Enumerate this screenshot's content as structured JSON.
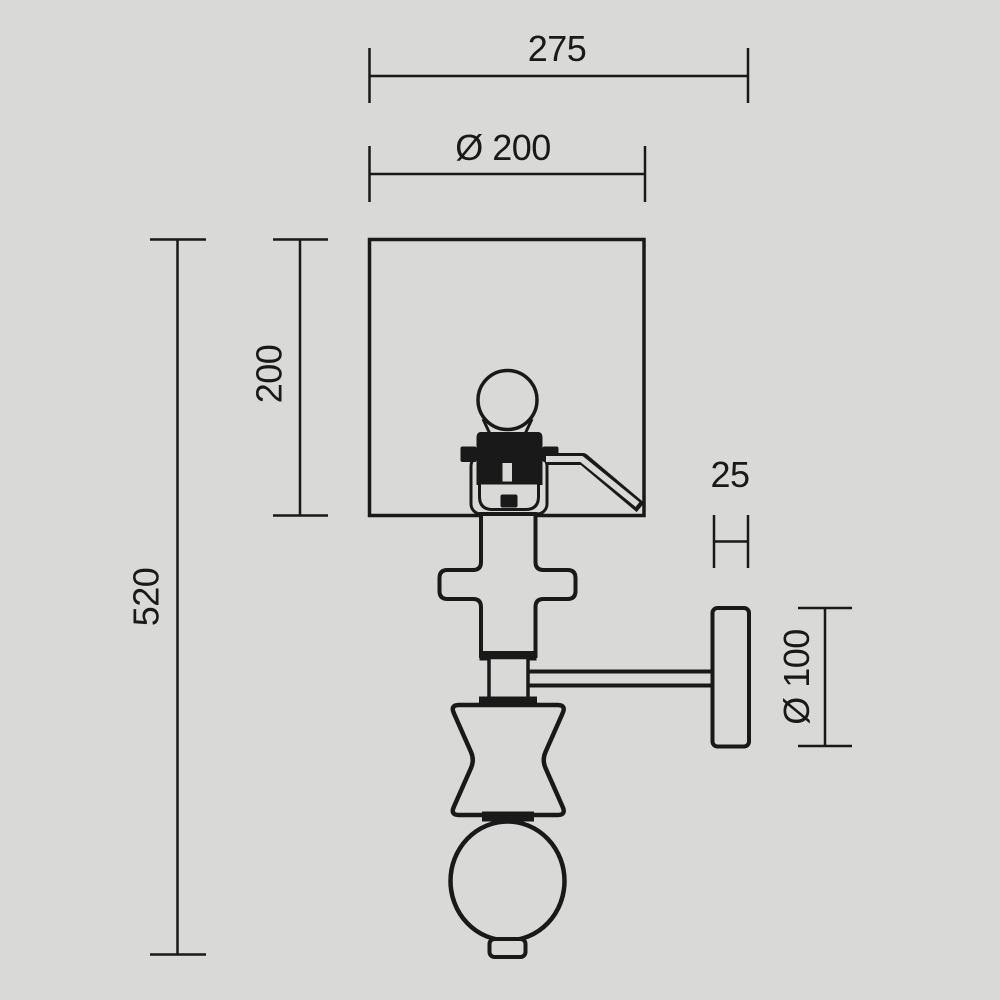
{
  "colors": {
    "background": "#d9d9d7",
    "line": "#191919",
    "text": "#191919"
  },
  "drawing_title": "wall-lamp-technical-drawing",
  "dimensions": {
    "total_width": "275",
    "shade_diameter": "Ø 200",
    "shade_height": "200",
    "total_height": "520",
    "plate_thickness": "25",
    "plate_diameter": "Ø 100"
  }
}
